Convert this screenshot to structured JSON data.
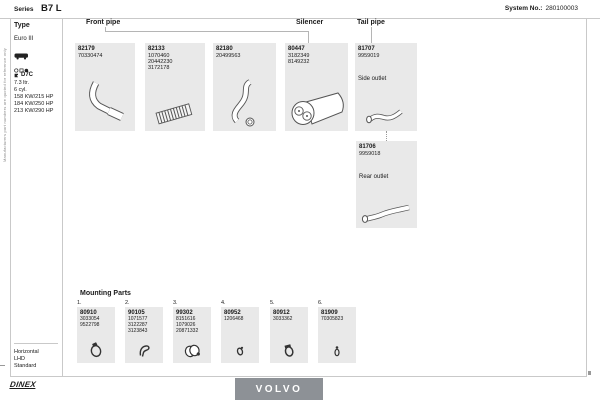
{
  "header": {
    "series_label": "Series",
    "series_value": "B7 L",
    "system_label": "System No.:",
    "system_value": "280100003"
  },
  "side_note": "Manufacturers part numbers are quoted for reference only",
  "sidebar": {
    "type_label": "Type",
    "euro_class": "Euro III",
    "engine_code": "D7C",
    "engine_displacement": "7.3 ltr.",
    "engine_cylinders": "6 cyl.",
    "power": [
      "158 KW/215 HP",
      "184 KW/250 HP",
      "213 KW/290 HP"
    ],
    "config": [
      "Horizontal",
      "LHD",
      "Standard"
    ]
  },
  "sections": [
    {
      "label": "Front pipe"
    },
    {
      "label": "Silencer"
    },
    {
      "label": "Tail pipe"
    }
  ],
  "parts": [
    {
      "id": "82179",
      "oem": [
        "70330474"
      ],
      "note": ""
    },
    {
      "id": "82133",
      "oem": [
        "1070460",
        "20442230",
        "3172178"
      ],
      "note": ""
    },
    {
      "id": "82180",
      "oem": [
        "20499563"
      ],
      "note": ""
    },
    {
      "id": "80447",
      "oem": [
        "3182349",
        "8149232"
      ],
      "note": ""
    },
    {
      "id": "81707",
      "oem": [
        "9959019"
      ],
      "note": "Side outlet"
    },
    {
      "id": "81706",
      "oem": [
        "9959018"
      ],
      "note": "Rear outlet"
    }
  ],
  "mounting": {
    "title": "Mounting Parts",
    "items": [
      {
        "index": "1.",
        "id": "80910",
        "oem": [
          "3033054",
          "9522798"
        ]
      },
      {
        "index": "2.",
        "id": "90105",
        "oem": [
          "1071577",
          "3122287",
          "3123843"
        ]
      },
      {
        "index": "3.",
        "id": "99302",
        "oem": [
          "8151616",
          "1079026",
          "20871332"
        ]
      },
      {
        "index": "4.",
        "id": "80952",
        "oem": [
          "1206468"
        ]
      },
      {
        "index": "5.",
        "id": "80912",
        "oem": [
          "3033362"
        ]
      },
      {
        "index": "6.",
        "id": "81909",
        "oem": [
          "70305823"
        ]
      }
    ]
  },
  "footer": {
    "brand": "VOLVO",
    "logo_text": "DINEX"
  },
  "colors": {
    "box_fill": "#e9e9e9",
    "brand_bar": "#8d9196",
    "rule": "#c9c9c9",
    "text": "#1a1a1a"
  }
}
